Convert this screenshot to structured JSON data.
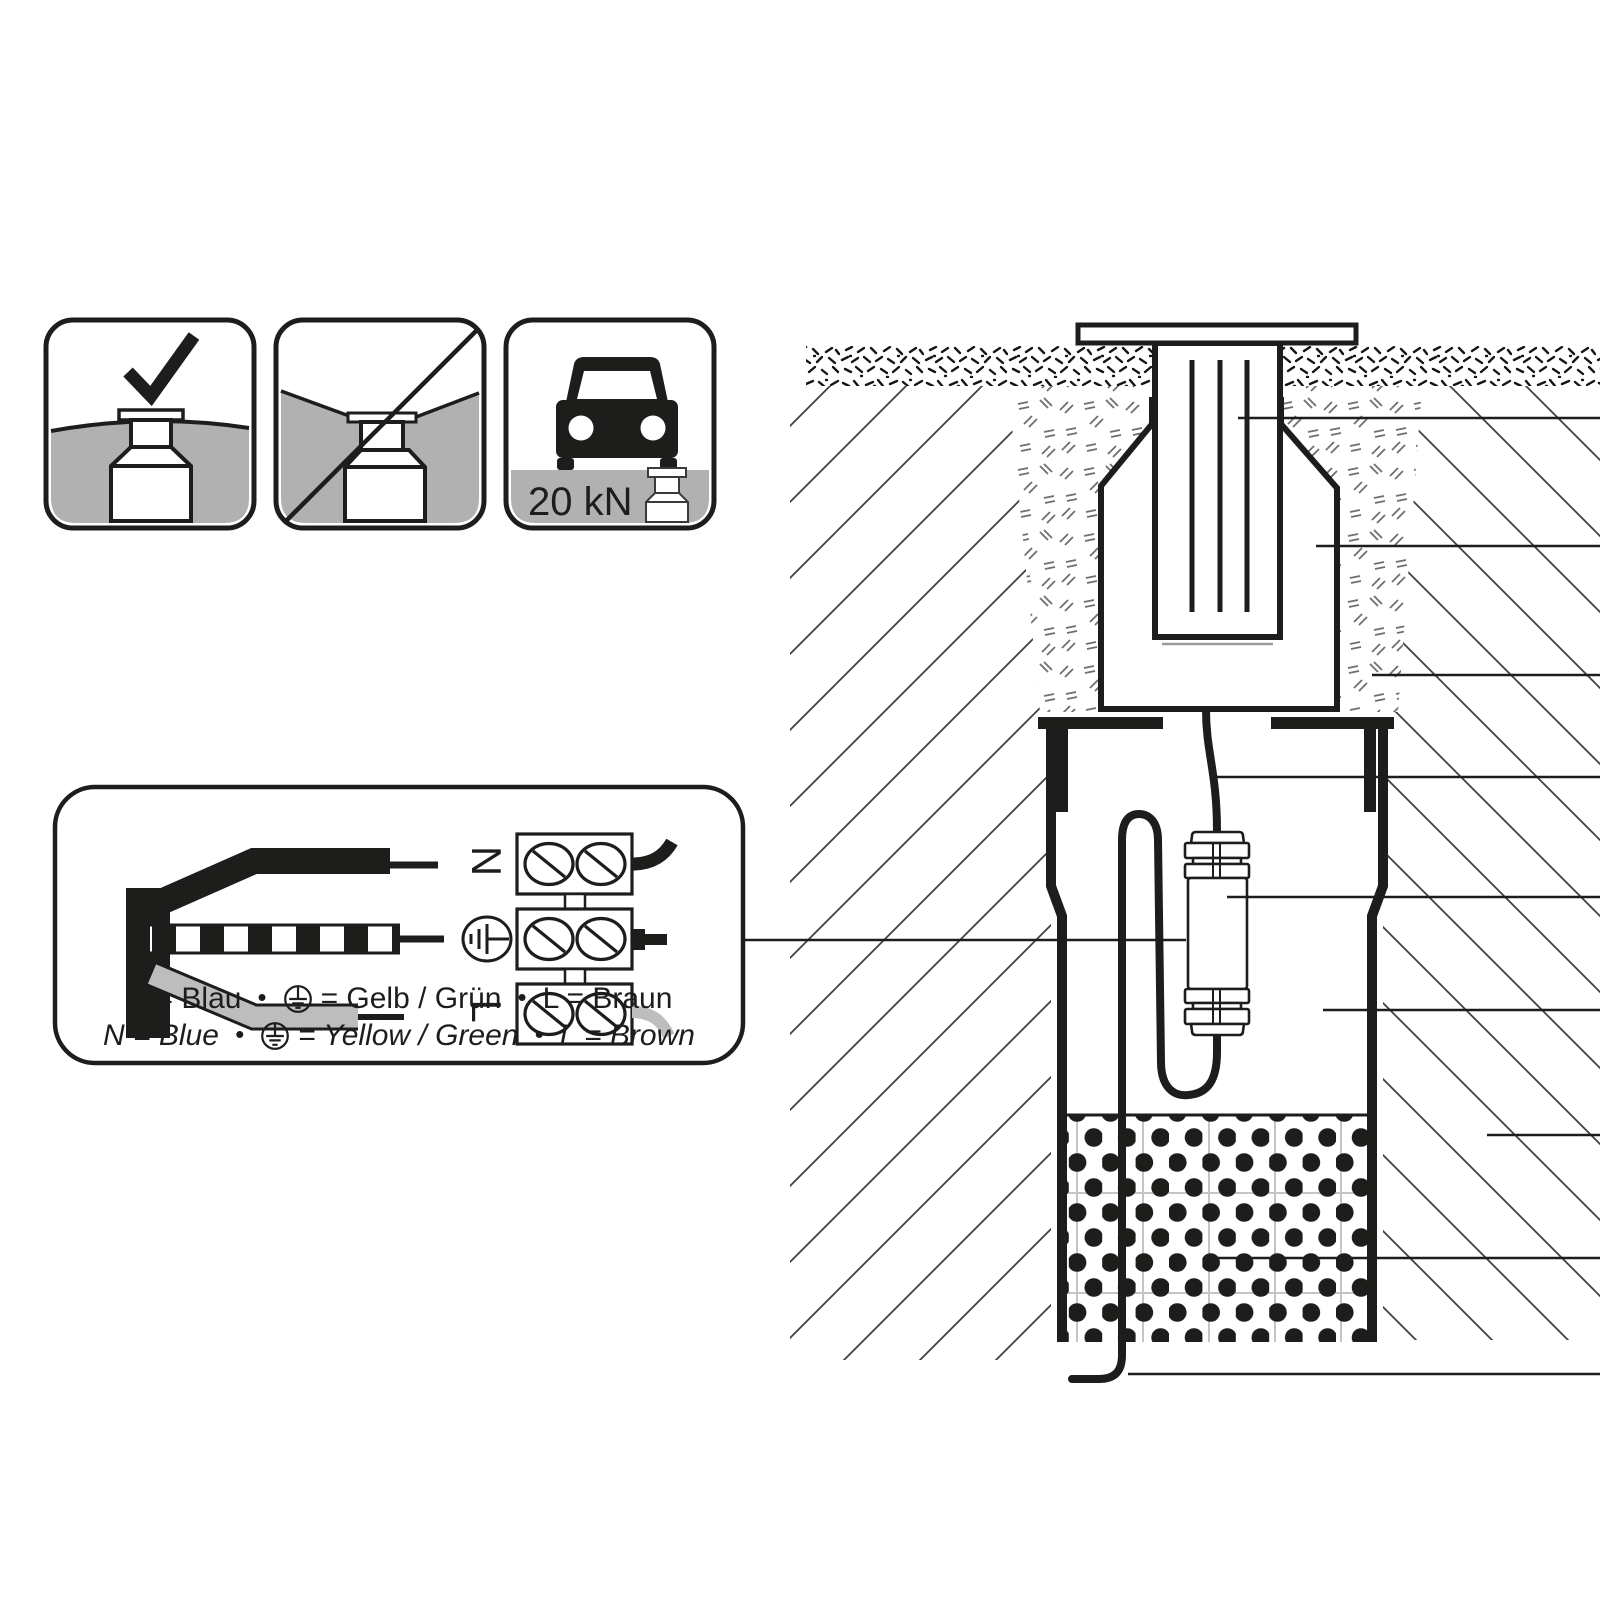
{
  "colors": {
    "ink": "#1d1d1b",
    "ground_gray": "#b1b1b1",
    "wire_gray": "#bdbdbd",
    "hatch_gray": "#3d3d3d",
    "stipple_gray": "#6e6e6e",
    "faint_grid_gray": "#c4c4c4"
  },
  "pictograms": {
    "allowed": {
      "icon": "check-icon",
      "meaning": "flush ground installation permitted"
    },
    "forbidden": {
      "icon": "prohibition-slash-icon",
      "meaning": "installation in depression not permitted"
    },
    "drive_over": {
      "icon": "car-icon",
      "load_label": "20 kN"
    }
  },
  "wiring": {
    "terminal_n": "N",
    "terminal_l": "L",
    "terminal_pe_icon": "earth-symbol-icon",
    "legend_de": {
      "n": "N = Blau",
      "bullet": "•",
      "pe_eq": "= Gelb / Grün",
      "l": "L = Braun"
    },
    "legend_en": {
      "n": "N = Blue",
      "bullet": "•",
      "pe_eq": "= Yellow / Green",
      "l": "L = Brown"
    }
  },
  "cross_section": {
    "leader_count": 9,
    "parts": [
      "luminaire insert",
      "outer housing",
      "backfill",
      "supply cable",
      "cable connector",
      "installation tube",
      "native soil",
      "gravel drainage",
      "cable exit"
    ]
  }
}
